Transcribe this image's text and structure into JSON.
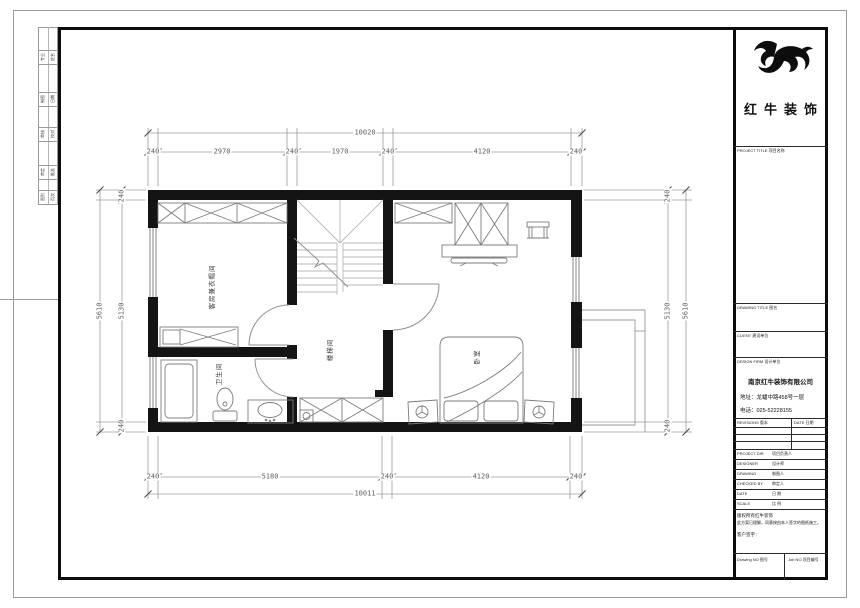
{
  "brand": {
    "logo_text": "红牛装饰"
  },
  "title_block": {
    "project_title_label": "PROJECT TITLE  项目名称",
    "drawing_title_label": "DRAWING TITLE  图名",
    "client_label": "CLIENT  建设单位",
    "design_firm_label": "DESIGN FIRM  设计单位",
    "company_name": "南京红牛装饰有限公司",
    "company_address": "地址：龙蟠中路458号一层",
    "company_phone": "电话：025-52228155",
    "revisions_label": "REVISIONS 版本",
    "date_col_label": "DATE 日期",
    "rows": [
      {
        "en": "PROJECT DIR",
        "zh": "项目负责人"
      },
      {
        "en": "DESIGNER",
        "zh": "设计师"
      },
      {
        "en": "DRAWING",
        "zh": "制图人"
      },
      {
        "en": "CHECKED BY",
        "zh": "审定人"
      },
      {
        "en": "DATE",
        "zh": "日  期"
      },
      {
        "en": "SCALE",
        "zh": "比  例"
      }
    ],
    "disclaimer_line1": "版权所有红牛装饰",
    "disclaimer_line2": "此方案已理解，同意按由本人签字的图纸施工。",
    "signature_label": "客户签字：",
    "drawing_no_label": "Drawing NO 图号",
    "job_no_label": "Job NO 项目编号"
  },
  "sign_strip": {
    "cells": [
      {
        "a": "专业",
        "b": "姓名"
      },
      {
        "a": "制图",
        "b": "日期"
      },
      {
        "a": "审核",
        "b": "校对"
      },
      {
        "a": "审定",
        "b": "批准"
      },
      {
        "a": "图别",
        "b": "页次"
      }
    ]
  },
  "rooms": [
    "客房兼衣帽间",
    "卫生间",
    "楼梯间",
    "卧室"
  ],
  "dimensions": {
    "top_total": "10020",
    "top_chain": [
      "240",
      "2970",
      "240",
      "1970",
      "240",
      "4120",
      "240"
    ],
    "bottom_chain": [
      "240",
      "5180",
      "240",
      "4120",
      "240"
    ],
    "bottom_total": "10011",
    "left_total": "5610",
    "left_chain": [
      "240",
      "5130",
      "240"
    ],
    "right_chain": [
      "240",
      "5130",
      "240"
    ],
    "right_total": "5610"
  }
}
